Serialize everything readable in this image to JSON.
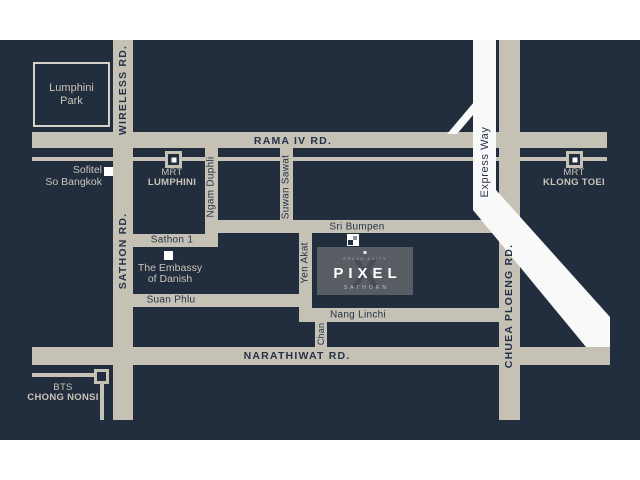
{
  "colors": {
    "page_bg": "#ffffff",
    "map_bg": "#222e3d",
    "road": "#c6c1b5",
    "road_text": "#243247",
    "light_text": "#c9c4b8",
    "expressway": "#f9f9f9",
    "logo_bg": "#585d64",
    "logo_watermark": "#474d55",
    "logo_text": "#ffffff",
    "logo_sub_text": "#c0c4c9"
  },
  "roads": {
    "rama_iv": "RAMA IV RD.",
    "wireless": "WIRELESS RD.",
    "sathon": "SATHON RD.",
    "ngam_duphli": "Ngam Duphli",
    "suwan_sawat": "Suwan Sawat",
    "sri_bumpen": "Sri Bumpen",
    "sathon_1": "Sathon 1",
    "yen_akat": "Yen Akat",
    "suan_phlu": "Suan Phlu",
    "nang_linchi": "Nang Linchi",
    "chan": "Chan",
    "narathiwat": "NARATHIWAT RD.",
    "chuea_ploeng": "CHUEA PLOENG RD.",
    "express_way": "Express Way"
  },
  "stations": {
    "mrt_lumphini": {
      "line1": "MRT",
      "line2": "LUMPHINI"
    },
    "mrt_klong_toei": {
      "line1": "MRT",
      "line2": "KLONG TOEI"
    },
    "bts_chong_nonsi": {
      "line1": "BTS",
      "line2": "CHONG NONSI"
    }
  },
  "landmarks": {
    "lumphini_park": {
      "line1": "Lumphini",
      "line2": "Park"
    },
    "sofitel": {
      "line1": "Sofitel",
      "line2": "So Bangkok"
    },
    "embassy": {
      "line1": "The Embassy",
      "line2": "of Danish"
    }
  },
  "project": {
    "brand": "GRAND UNITY",
    "name": "PIXEL",
    "watermark": "X",
    "district": "SATHORN"
  }
}
